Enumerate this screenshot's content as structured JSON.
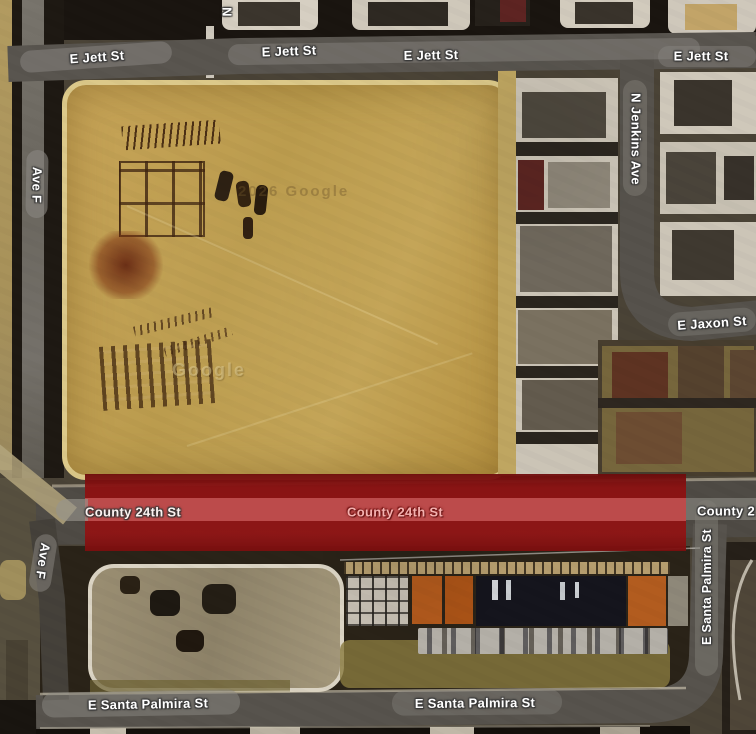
{
  "map": {
    "type": "satellite-view",
    "highlight_color": "#8e1313",
    "ribbon_color": "#c05050",
    "road_color": "#57534d",
    "sand_color": "#c2a155",
    "watermark_primary": "2026 Google",
    "watermark_secondary": "Google"
  },
  "streets": {
    "e_jett_st": "E Jett St",
    "ave_f": "Ave F",
    "n_partial": "N",
    "n_jenkins_ave": "N Jenkins Ave",
    "e_jaxon_st": "E Jaxon St",
    "county_24th_st": "County 24th St",
    "county_24th_partial": "County 2",
    "e_santa_palmira_st": "E Santa Palmira St"
  }
}
